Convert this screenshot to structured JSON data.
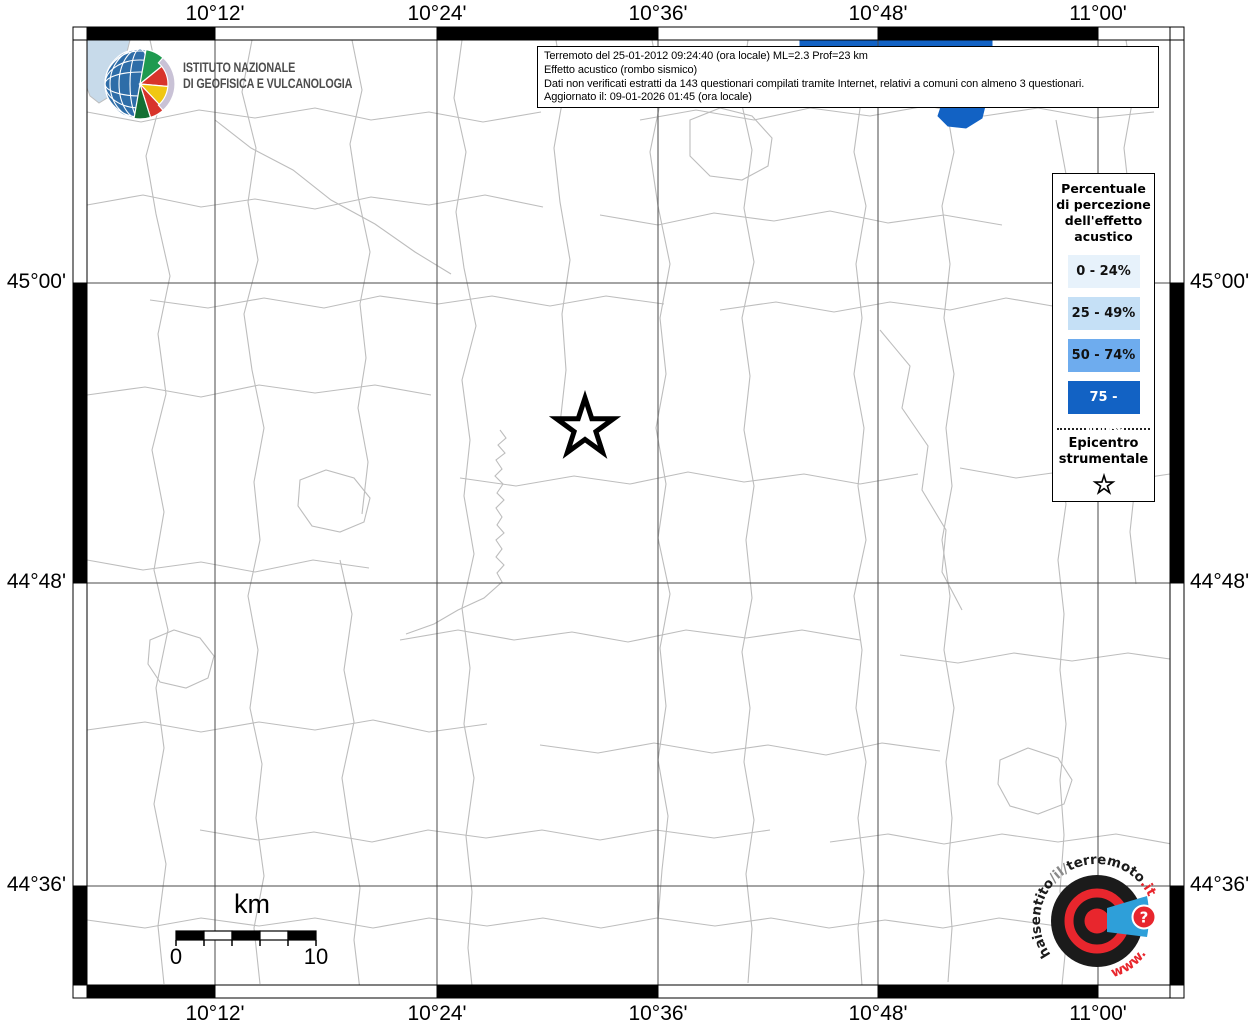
{
  "info_box": {
    "lines": [
      "Terremoto del 25-01-2012 09:24:40 (ora locale) ML=2.3 Prof=23 km",
      "Effetto acustico (rombo sismico)",
      "Dati non verificati estratti da 143 questionari compilati tramite Internet, relativi a comuni con almeno 3 questionari.",
      "Aggiornato il: 09-01-2026 01:45 (ora locale)"
    ]
  },
  "ingv": {
    "name_line1": "ISTITUTO NAZIONALE",
    "name_line2": "DI GEOFISICA E VULCANOLOGIA"
  },
  "axes": {
    "lon_labels": [
      "10°12'",
      "10°24'",
      "10°36'",
      "10°48'",
      "11°00'"
    ],
    "lon_x": [
      215,
      437,
      658,
      878,
      1098
    ],
    "lat_labels": [
      "45°00'",
      "44°48'",
      "44°36'"
    ],
    "lat_y": [
      283,
      583,
      886
    ]
  },
  "legend": {
    "title_lines": [
      "Percentuale",
      "di percezione",
      "dell'effetto",
      "acustico"
    ],
    "classes": [
      {
        "label": "0 - 24%",
        "color": "#E7F2FB",
        "text": "#111111"
      },
      {
        "label": "25 - 49%",
        "color": "#C5E0F6",
        "text": "#111111"
      },
      {
        "label": "50 - 74%",
        "color": "#6EACEE",
        "text": "#111111"
      },
      {
        "label": "75 - 100%",
        "color": "#1262C4",
        "text": "#FFFFFF"
      }
    ],
    "epicenter_lines": [
      "Epicentro",
      "strumentale"
    ]
  },
  "scalebar": {
    "unit": "km",
    "start_label": "0",
    "end_label": "10"
  },
  "epicenter": {
    "x": 585,
    "y": 428,
    "outer_r": 30,
    "inner_r": 11.5
  },
  "hsit": {
    "arc_pre": "haisentito",
    "arc_sep": "/il/",
    "arc_main": "terremoto",
    "arc_suffix": ".it",
    "www": "www.",
    "qmark": "?"
  },
  "colors": {
    "boundary": "#bdbdbd",
    "graticule": "#4a4a4a",
    "water": "#C7DAEA",
    "class4": "#1262C4",
    "frame_black": "#000000",
    "frame_white": "#ffffff",
    "hsit_red": "#E8262D",
    "hsit_blue": "#2E9FD9",
    "hsit_black": "#1b1b1b"
  },
  "map": {
    "water_path": "M 87 40 L 130 40 L 127 52 L 133 66 L 124 82 L 112 95 L 99 103 L 90 96 L 87 88 Z",
    "class4_path": "M 800 40 L 992 40 L 992 58 L 975 70 L 962 84 L 950 92 L 958 104 L 985 106 L 982 118 L 966 128 L 948 126 L 938 116 L 942 104 L 925 96 L 900 80 L 870 62 L 835 52 L 800 46 Z",
    "boundaries": [
      "M 150 40 l 12 56 l -16 60 l 10 58 l 14 62 l -12 58 l 8 60 l -14 56 l 12 62 l -10 58 l 14 60 l -12 58 l 8 60 l -10 56 l 12 60 l -8 62 l 6 58",
      "M 252 40 l -10 52 l 14 56 l -8 54 l 10 58 l -14 54 l 8 56 l 12 58 l -10 54 l 6 58 l -12 56 l 10 54 l -8 58 l 12 56 l -6 54 l 8 58 l -10 52 l 6 56",
      "M 352 40 l 10 50 l -12 54 l 8 52 l 12 56 l -10 52 l 6 54 l -8 50 l 10 54 l -6 52",
      "M 340 560 l 12 54 l -8 56 l 10 52 l -12 56 l 8 54 l 10 56 l -6 52 l 6 50",
      "M 462 40 l -8 58 l 12 54 l -10 60 l 8 56 l 12 58 l -14 54 l 8 60 l -6 56 l 10 58 l -12 54 l 8 60 l -6 56 l 10 54 l -8 58 l 6 56 l -4 56 l 4 38",
      "M 556 40 l 8 52 l -10 56 l 6 54 l 10 58 l -8 54 l 4 56 l -6 54",
      "M 652 40 l 10 54 l -12 58 l 8 54 l 12 58 l -10 54 l 6 56 l -10 54 l 10 56 l -8 54 l 12 56 l -10 54 l 6 58 l -8 54 l 10 56 l -6 54 l -4 50",
      "M 748 40 l -8 56 l 12 54 l -8 58 l 10 54 l -12 56 l 8 58 l -6 54 l 10 56 l -8 54 l 6 58 l -10 54 l 8 56 l -6 54 l 10 58 l -8 54 l 6 55 l -4 54",
      "M 852 40 l 10 54 l -8 58 l 12 54 l -10 58 l 6 54 l -8 56 l 10 54 l -6 58 l 8 54 l -12 56 l 8 54 l -6 58 l 10 54 l -8 56 l 6 54 l -6 56 l 4 58",
      "M 952 40 l -8 54 l 10 58 l -12 54 l 8 58 l -6 54 l 10 56 l -8 54 l 6 58 l -10 54 l 8 56 l -6 54 l 10 58 l -8 54 l 6 56 l -4 54 l 4 56 l -4 54",
      "M 1056 120 l 10 54 l -8 56 l 6 54 l -10 56 l 8 54 l -6 56 l 10 54 l -8 56 l 6 54 l -4 56 l 6 54 l -6 56 l 4 55 l -4 56 l 6 54 l -4 40",
      "M 1126 40 l 8 52 l -10 56 l 6 54 l 10 56 l -8 54 l 4 56 l -8 54 l 8 54 l -6 56 l 6 52",
      "M 87 112 l 54 10 l 58 -12 l 56 8 l 60 -10 l 56 12 l 58 -8 l 54 10 l 58 -10",
      "M 640 120 l 56 -10 l 58 10 l 56 -12 l 60 8 l 56 -10 l 58 10 l 54 -8 l 56 10 l 60 -6",
      "M 87 205 l 56 -10 l 58 12 l 54 -8 l 60 10 l 56 -12 l 58 8 l 56 -10 l 58 12",
      "M 600 215 l 58 10 l 56 -12 l 60 8 l 56 -10 l 58 12 l 56 -8 l 58 10",
      "M 150 300 l 58 8 l 56 -10 l 60 10 l 56 -12 l 58 8 l 54 -8 l 58 10 l 56 -10 l 58 8",
      "M 720 310 l 56 -8 l 58 10 l 56 -10 l 60 8 l 56 -12 l 58 10 l 54 -8",
      "M 87 395 l 58 -8 l 56 10 l 58 -12 l 56 8 l 60 -8 l 56 10",
      "M 460 478 l 56 8 l 58 -10 l 56 8 l 58 -12 l 56 10 l 60 -8 l 56 10 l 58 -10",
      "M 960 468 l 56 10 l 58 -8 l 56 10 l 40 -6",
      "M 87 560 l 56 10 l 58 -8 l 54 10 l 58 -12 l 56 8",
      "M 400 640 l 58 -10 l 56 10 l 58 -8 l 56 10 l 58 -12 l 60 8 l 56 -8 l 58 10",
      "M 900 655 l 58 8 l 56 -10 l 58 8 l 56 -8 l 42 6",
      "M 87 730 l 58 -8 l 56 10 l 58 -10 l 56 8 l 58 -10 l 56 12 l 58 -8",
      "M 540 745 l 58 8 l 56 -10 l 58 10 l 56 -8 l 58 10 l 56 -12 l 58 8",
      "M 200 830 l 58 10 l 56 -8 l 58 10 l 56 -12 l 58 8 l 56 -8 l 58 10 l 56 -10 l 58 8 l 56 -8",
      "M 830 842 l 58 -8 l 56 10 l 58 -10 l 56 8 l 58 -8 l 56 10",
      "M 87 920 l 58 8 l 56 -10 l 58 8 l 56 -8 l 58 10 l 56 -10 l 58 8 l 56 -8 l 58 10 l 56 -10 l 58 8 l 56 -8 l 58 10 l 56 -8 l 58 8 l 56 -10 l 58 8",
      "M 500 430 l 6 8 l -8 7 l 7 8 l -9 7 l 6 9 l -7 7 l 8 8 l -6 9 l 7 7 l -8 8 l 6 9 l -5 8 l 7 8 l -8 7 l 6 9 l -6 8 l 8 8 l -7 8 l 5 9 l -18 16 l -26 12 l -24 14 l -28 10",
      "M 215 120 l 36 28 l 42 22 l 38 30 l 44 24 l 40 28 l 36 22",
      "M 880 330 l 30 36 l -8 42 l 26 38 l -6 44 l 24 40 l -4 42 l 20 38",
      "M 690 120 l 30 -12 l 32 8 l 20 22 l -4 28 l -26 14 l -32 -4 l -20 -20 z",
      "M 300 480 l 26 -10 l 28 8 l 16 20 l -6 24 l -24 10 l -28 -6 l -14 -20 z",
      "M 1000 760 l 28 -12 l 30 10 l 14 22 l -8 24 l -26 10 l -28 -8 l -12 -22 z",
      "M 150 640 l 24 -10 l 26 8 l 14 18 l -6 22 l -22 10 l -26 -6 l -12 -18 z"
    ]
  }
}
